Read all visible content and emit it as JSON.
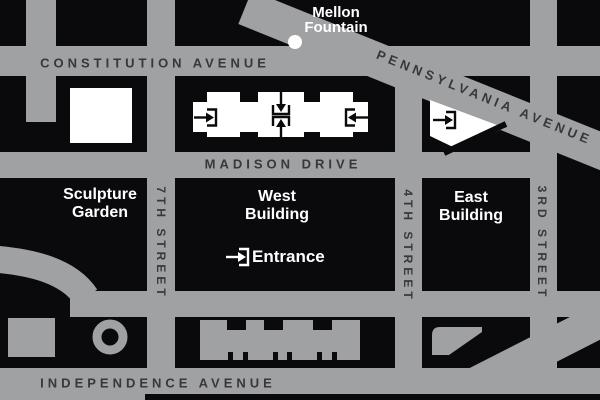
{
  "map": {
    "streets": {
      "constitution": "CONSTITUTION AVENUE",
      "pennsylvania": "PENNSYLVANIA AVENUE",
      "madison": "MADISON DRIVE",
      "independence": "INDEPENDENCE AVENUE",
      "seventh": "7TH STREET",
      "fourth": "4TH STREET",
      "third": "3RD STREET"
    },
    "landmarks": {
      "mellon_line1": "Mellon",
      "mellon_line2": "Fountain",
      "sculpture_line1": "Sculpture",
      "sculpture_line2": "Garden",
      "west_line1": "West",
      "west_line2": "Building",
      "east_line1": "East",
      "east_line2": "Building",
      "entrance": "Entrance"
    },
    "colors": {
      "block_fill": "#0a0a0c",
      "street_fill": "#9fa1a2",
      "street_label": "#38383a",
      "building_fill": "#ffffff"
    }
  }
}
